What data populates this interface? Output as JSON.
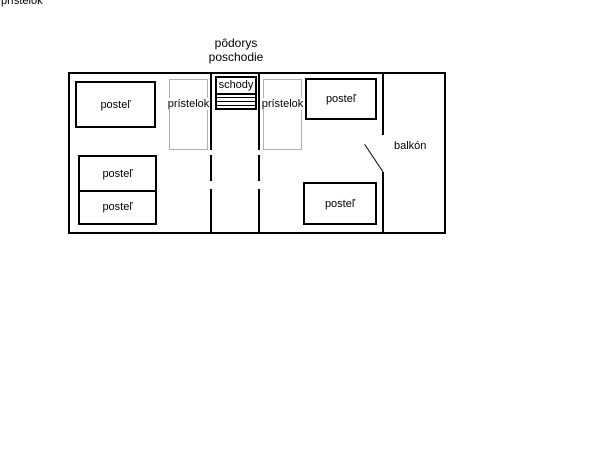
{
  "corner_label": "prístelok",
  "title": {
    "line1": "pôdorys",
    "line2": "poschodie"
  },
  "plan": {
    "beds": [
      {
        "label": "posteľ"
      },
      {
        "label": "posteľ"
      },
      {
        "label": "posteľ"
      },
      {
        "label": "posteľ"
      },
      {
        "label": "posteľ"
      }
    ],
    "annexes": [
      {
        "label": "prístelok"
      },
      {
        "label": "prístelok"
      }
    ],
    "stairs": {
      "label": "schody"
    },
    "balcony_label": "balkón",
    "colors": {
      "wall": "#000000",
      "annex_border": "#b0b0b0",
      "background": "#ffffff"
    }
  }
}
